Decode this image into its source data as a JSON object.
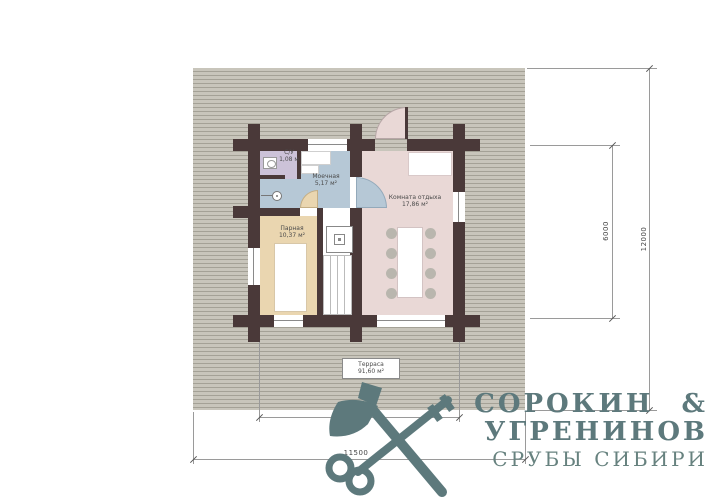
{
  "plan": {
    "rooms": [
      {
        "name": "С/У",
        "area": "1,08 м"
      },
      {
        "name": "Моечная",
        "area": "5,17 м²"
      },
      {
        "name": "Парная",
        "area": "10,37 м²"
      },
      {
        "name": "Комната отдыха",
        "area": "17,86 м²"
      },
      {
        "name": "Терраса",
        "area": "91,60 м²"
      }
    ],
    "dimensions": {
      "building_width": "7000",
      "building_depth": "6000",
      "terrace_width": "11500",
      "terrace_depth": "12000"
    },
    "colors": {
      "wall": "#4a3939",
      "room_su": "#ccc2d8",
      "room_wash": "#b6c8d6",
      "room_steam": "#ead6b0",
      "room_rest": "#e9d8d6",
      "terrace_base": "#c8c5bb",
      "terrace_stripe": "#a4a196",
      "logo": "#5d797c"
    }
  },
  "logo": {
    "line1": "СОРОКИН &",
    "line2": "УГРЕНИНОВ",
    "line3": "СРУБЫ СИБИРИ"
  }
}
